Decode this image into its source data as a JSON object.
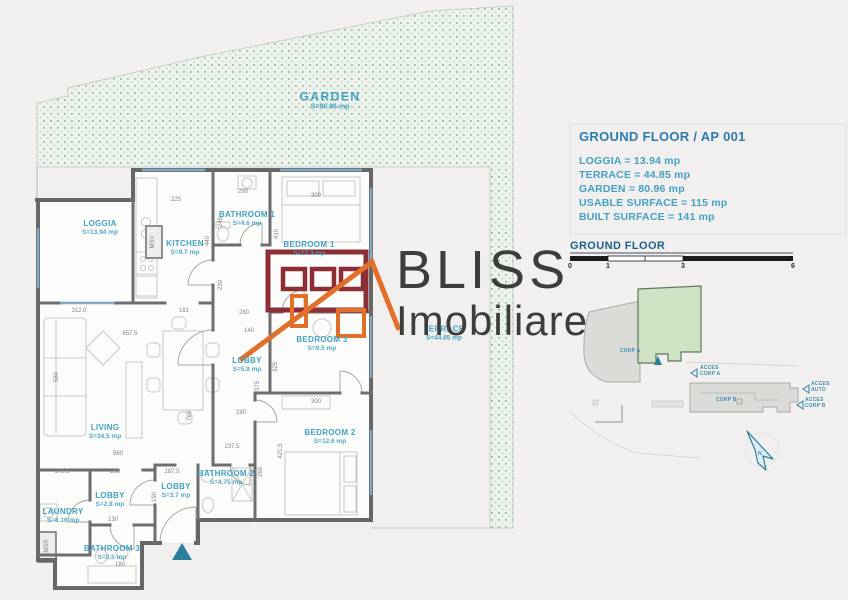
{
  "logo": {
    "line1": "BLISS",
    "line2": "Imobiliare"
  },
  "garden": {
    "label": "GARDEN",
    "area": "S=80.96 mp"
  },
  "terrace": {
    "label": "TERRACE",
    "area": "S=44.85 mp"
  },
  "info_panel": {
    "title": "GROUND FLOOR / AP 001",
    "lines": [
      "LOGGIA = 13.94 mp",
      "TERRACE = 44.85 mp",
      "GARDEN = 80.96 mp",
      "USABLE SURFACE = 115 mp",
      "BUILT SURFACE = 141 mp"
    ]
  },
  "scale_bar": {
    "title": "GROUND FLOOR",
    "ticks": [
      {
        "t": "0",
        "x": 570,
        "y": 263
      },
      {
        "t": "1",
        "x": 608,
        "y": 263
      },
      {
        "t": "3",
        "x": 683,
        "y": 263
      },
      {
        "t": "6",
        "x": 793,
        "y": 263
      }
    ]
  },
  "rooms": [
    {
      "name": "room-label-loggia",
      "label": "LOGGIA",
      "area": "S=13.94 mp",
      "x": 100,
      "y": 228
    },
    {
      "name": "room-label-kitchen",
      "label": "KITCHEN",
      "area": "S=9.7 mp",
      "x": 185,
      "y": 248
    },
    {
      "name": "room-label-bathroom1",
      "label": "BATHROOM 1",
      "area": "S=4.6 mp",
      "x": 247,
      "y": 219
    },
    {
      "name": "room-label-bedroom1",
      "label": "BEDROOM 1",
      "area": "S=17.3 mp",
      "x": 309,
      "y": 249
    },
    {
      "name": "room-label-lobby1",
      "label": "LOBBY",
      "area": "S=5.9 mp",
      "x": 247,
      "y": 365
    },
    {
      "name": "room-label-bedroom3",
      "label": "BEDROOM 3",
      "area": "S=9.5 mp",
      "x": 322,
      "y": 344
    },
    {
      "name": "room-label-living",
      "label": "LIVING",
      "area": "S=34.5 mp",
      "x": 105,
      "y": 432
    },
    {
      "name": "room-label-bedroom2",
      "label": "BEDROOM 2",
      "area": "S=12.6 mp",
      "x": 330,
      "y": 437
    },
    {
      "name": "room-label-bathroom2",
      "label": "BATHROOM 2",
      "area": "S=4.75 mp",
      "x": 226,
      "y": 478
    },
    {
      "name": "room-label-lobby3",
      "label": "LOBBY",
      "area": "S=3.7 mp",
      "x": 176,
      "y": 491
    },
    {
      "name": "room-label-lobby2",
      "label": "LOBBY",
      "area": "S=2.8 mp",
      "x": 110,
      "y": 500
    },
    {
      "name": "room-label-laundry",
      "label": "LAUNDRY",
      "area": "S=6.16 mp",
      "x": 63,
      "y": 516
    },
    {
      "name": "room-label-bathroom3",
      "label": "BATHROOM 3",
      "area": "S=3.5 mp",
      "x": 112,
      "y": 553
    }
  ],
  "dimensions": [
    {
      "t": "225",
      "x": 176,
      "y": 200
    },
    {
      "t": "290",
      "x": 243,
      "y": 192
    },
    {
      "t": "300",
      "x": 316,
      "y": 196
    },
    {
      "t": "248",
      "x": 221,
      "y": 222,
      "r": -90
    },
    {
      "t": "440",
      "x": 208,
      "y": 241,
      "r": -90
    },
    {
      "t": "410",
      "x": 277,
      "y": 234,
      "r": -90
    },
    {
      "t": "230",
      "x": 221,
      "y": 285,
      "r": -90
    },
    {
      "t": "MSV",
      "x": 153,
      "y": 242,
      "r": -90
    },
    {
      "t": "312.0",
      "x": 79,
      "y": 311
    },
    {
      "t": "181",
      "x": 184,
      "y": 311
    },
    {
      "t": "657.5",
      "x": 130,
      "y": 334
    },
    {
      "t": "580",
      "x": 57,
      "y": 377,
      "r": -90
    },
    {
      "t": "765",
      "x": 190,
      "y": 416,
      "r": -90
    },
    {
      "t": "560",
      "x": 118,
      "y": 454
    },
    {
      "t": "280",
      "x": 244,
      "y": 313
    },
    {
      "t": "140",
      "x": 249,
      "y": 331
    },
    {
      "t": "325",
      "x": 276,
      "y": 367,
      "r": -90
    },
    {
      "t": "375",
      "x": 258,
      "y": 386,
      "r": -90
    },
    {
      "t": "300",
      "x": 316,
      "y": 402
    },
    {
      "t": "280",
      "x": 241,
      "y": 413
    },
    {
      "t": "237.5",
      "x": 232,
      "y": 447
    },
    {
      "t": "260",
      "x": 261,
      "y": 472,
      "r": -90
    },
    {
      "t": "421.5",
      "x": 281,
      "y": 451,
      "r": -90
    },
    {
      "t": "172.5",
      "x": 62,
      "y": 472
    },
    {
      "t": "180",
      "x": 115,
      "y": 472
    },
    {
      "t": "187.5",
      "x": 172,
      "y": 472
    },
    {
      "t": "130",
      "x": 113,
      "y": 520
    },
    {
      "t": "190",
      "x": 155,
      "y": 497,
      "r": -90
    },
    {
      "t": "180",
      "x": 120,
      "y": 565
    },
    {
      "t": "MSR",
      "x": 47,
      "y": 546,
      "r": -90
    }
  ],
  "site_plan": {
    "labels": [
      {
        "t": "CORP A",
        "x": 620,
        "y": 349
      },
      {
        "t": "CORP B",
        "x": 716,
        "y": 398
      },
      {
        "t": "ACCES",
        "x": 700,
        "y": 366
      },
      {
        "t": "CORP A",
        "x": 700,
        "y": 372
      },
      {
        "t": "ACCES",
        "x": 811,
        "y": 382
      },
      {
        "t": "AUTO",
        "x": 811,
        "y": 388
      },
      {
        "t": "ACCES",
        "x": 805,
        "y": 398
      },
      {
        "t": "CORP B",
        "x": 805,
        "y": 404
      },
      {
        "t": "N",
        "x": 758,
        "y": 452
      }
    ]
  },
  "colors": {
    "accent_teal": "#42a2c3",
    "title_blue": "#2b7db0",
    "wall_gray": "#67676a",
    "logo_maroon": "#8d2e36",
    "logo_orange": "#e2702a",
    "garden_green": "#92bf9b"
  }
}
